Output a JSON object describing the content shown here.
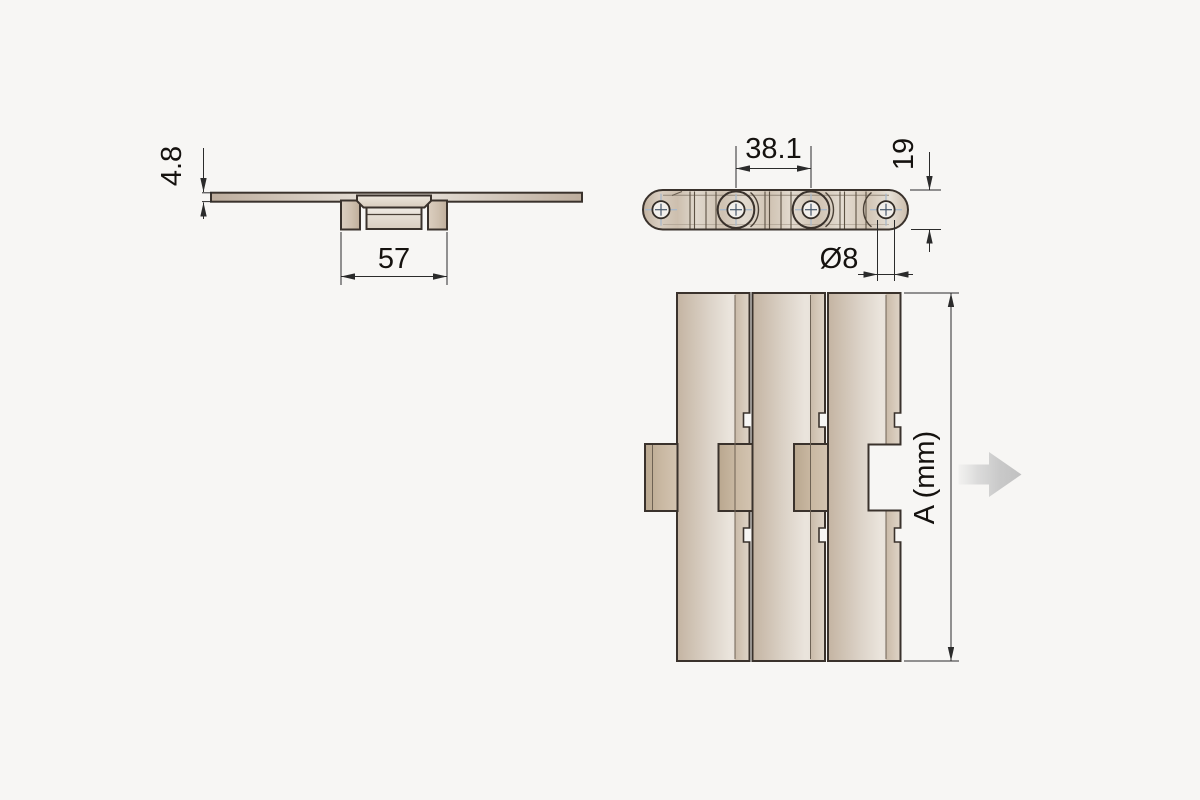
{
  "drawing": {
    "description": "flat-top conveyor chain technical drawing, three views",
    "colors": {
      "background": "#f7f6f4",
      "outline": "#3a322c",
      "plate_tan": "#d6c9ba",
      "plate_tan_dark": "#c2ae97",
      "centerline_blue": "#a9b8c9",
      "direction_arrow_gray": "#c6c6c6",
      "dimension_line": "#2b2b2b"
    },
    "views": {
      "end_view": {
        "thickness_label": "4.8",
        "hinge_width_label": "57"
      },
      "side_view": {
        "pitch_label": "38.1",
        "height_label": "19",
        "pin_diameter_label": "Ø8"
      },
      "top_view": {
        "belt_width_label": "A (mm)"
      }
    },
    "icons": {
      "direction_arrow": "right-arrow"
    }
  }
}
